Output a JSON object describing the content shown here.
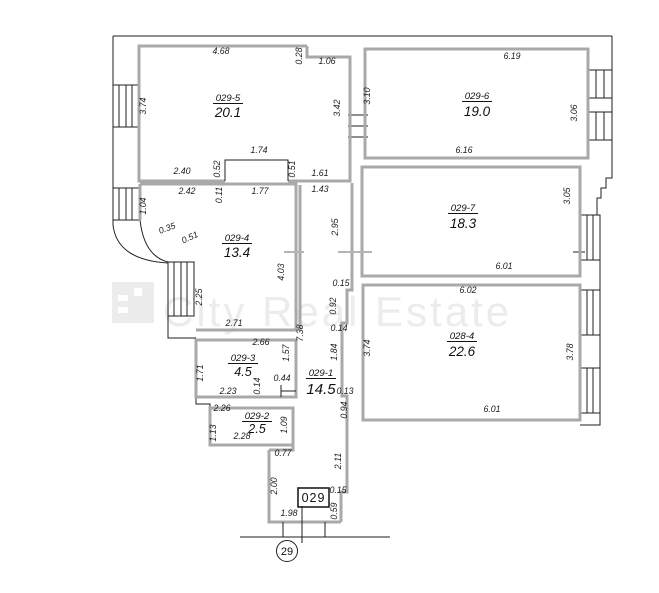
{
  "watermark": {
    "text": "City Real Estate"
  },
  "unit": {
    "box_label": "029",
    "site_number": "29"
  },
  "rooms": [
    {
      "id": "029-5",
      "area": "20.1"
    },
    {
      "id": "029-6",
      "area": "19.0"
    },
    {
      "id": "029-7",
      "area": "18.3"
    },
    {
      "id": "029-4",
      "area": "13.4"
    },
    {
      "id": "029-3",
      "area": "4.5"
    },
    {
      "id": "029-1",
      "area": "14.5"
    },
    {
      "id": "029-2",
      "area": "2.5"
    },
    {
      "id": "028-4",
      "area": "22.6"
    }
  ],
  "dims": [
    "4.68",
    "0.28",
    "1.06",
    "6.19",
    "3.74",
    "3.10",
    "3.42",
    "3.06",
    "2.40",
    "0.52",
    "1.74",
    "0.51",
    "1.61",
    "6.16",
    "2.42",
    "0.11",
    "1.77",
    "1.43",
    "1.04",
    "3.05",
    "0.35",
    "0.51",
    "2.95",
    "6.01",
    "2.25",
    "4.03",
    "6.02",
    "0.15",
    "2.71",
    "7.38",
    "0.92",
    "0.14",
    "3.74",
    "3.78",
    "2.66",
    "1.57",
    "1.84",
    "1.71",
    "2.23",
    "0.14",
    "0.44",
    "0.13",
    "0.94",
    "6.01",
    "2.26",
    "1.09",
    "1.13",
    "2.28",
    "0.77",
    "2.11",
    "2.00",
    "0.15",
    "0.59",
    "1.98"
  ]
}
